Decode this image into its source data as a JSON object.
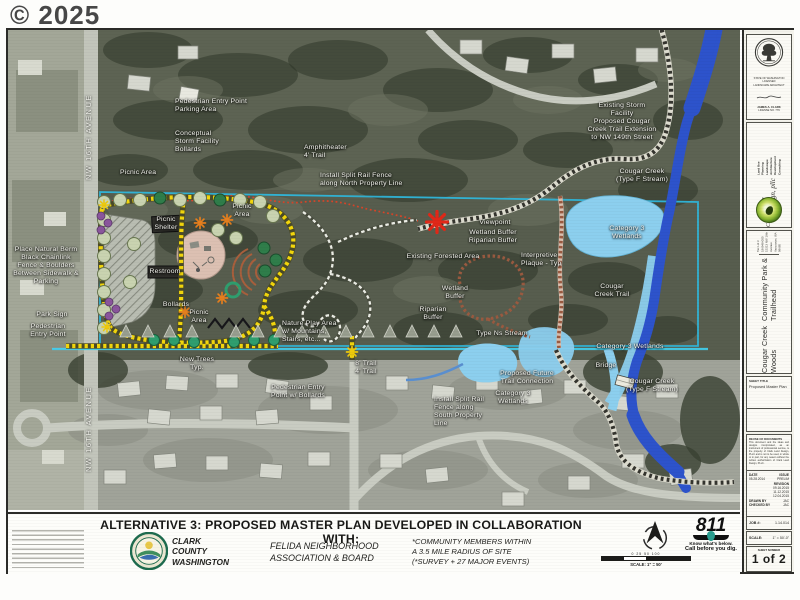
{
  "watermark": "© 2025",
  "map": {
    "street_labels": [
      {
        "name": "street-label-nw-16th-avenue-north",
        "text": "NW 16TH AVENUE"
      },
      {
        "name": "street-label-nw-16th-avenue-south",
        "text": "NW 16TH AVENUE"
      }
    ],
    "labels": [
      {
        "name": "label-pedestrian-entry-parking",
        "text": "Pedestrian Entry Point\nParking Area",
        "x": 167,
        "y": 76,
        "align": "left"
      },
      {
        "name": "label-conceptual-storm-facility",
        "text": "Conceptual\nStorm Facility\nBollards",
        "x": 167,
        "y": 112,
        "align": "left"
      },
      {
        "name": "label-picnic-area-west",
        "text": "Picnic Area",
        "x": 112,
        "y": 143,
        "align": "left"
      },
      {
        "name": "label-amphitheater",
        "text": "Amphitheater\n4' Trail",
        "x": 296,
        "y": 122,
        "align": "left"
      },
      {
        "name": "label-fence-north",
        "text": "Install Split Rail Fence\nalong North Property Line",
        "x": 312,
        "y": 150,
        "align": "left"
      },
      {
        "name": "label-existing-storm-facility",
        "text": "Existing Storm\nFacility\nProposed Cougar\nCreek Trail Extension\nto NW 149th Street",
        "x": 614,
        "y": 92,
        "align": "center"
      },
      {
        "name": "label-cougar-creek-north",
        "text": "Cougar Creek\n(Type F Stream)",
        "x": 634,
        "y": 146,
        "align": "center"
      },
      {
        "name": "label-viewpoint",
        "text": "Viewpoint",
        "x": 487,
        "y": 193,
        "align": "center"
      },
      {
        "name": "label-wetland-riparian-buffer",
        "text": "Wetland Buffer\nRiparian Buffer",
        "x": 485,
        "y": 207,
        "align": "center"
      },
      {
        "name": "label-existing-forested-area",
        "text": "Existing Forested Area",
        "x": 435,
        "y": 227,
        "align": "center"
      },
      {
        "name": "label-interpretive-plaque",
        "text": "Interpretive\nPlaque - Typ",
        "x": 513,
        "y": 230,
        "align": "left"
      },
      {
        "name": "label-wetland-buffer",
        "text": "Wetland\nBuffer",
        "x": 447,
        "y": 263,
        "align": "center"
      },
      {
        "name": "label-riparian-buffer",
        "text": "Riparian\nBuffer",
        "x": 425,
        "y": 284,
        "align": "center"
      },
      {
        "name": "label-type-ns-stream",
        "text": "Type Ns Stream",
        "x": 494,
        "y": 304,
        "align": "center"
      },
      {
        "name": "label-category3-wetlands",
        "text": "Category 3\nWetlands",
        "x": 619,
        "y": 203,
        "align": "center"
      },
      {
        "name": "label-cougar-creek-trail",
        "text": "Cougar\nCreek Trail",
        "x": 604,
        "y": 261,
        "align": "center"
      },
      {
        "name": "label-category3-wetlands-south",
        "text": "Category 3 Wetlands",
        "x": 622,
        "y": 317,
        "align": "center"
      },
      {
        "name": "label-bridge",
        "text": "Bridge",
        "x": 598,
        "y": 336,
        "align": "center"
      },
      {
        "name": "label-cougar-creek-south",
        "text": "Cougar Creek\n(Type F Stream)",
        "x": 644,
        "y": 356,
        "align": "center"
      },
      {
        "name": "label-future-trail-connection",
        "text": "Proposed Future\nTrail Connection",
        "x": 519,
        "y": 348,
        "align": "center"
      },
      {
        "name": "label-category3-wetlands-small",
        "text": "Category 3\nWetlands",
        "x": 505,
        "y": 368,
        "align": "center"
      },
      {
        "name": "label-fence-south",
        "text": "Install Split Rail\nFence along\nSouth Property\nLine",
        "x": 426,
        "y": 382,
        "align": "left"
      },
      {
        "name": "label-natural-berm",
        "text": "Place Natural Berm\nBlack Chainlink\nFence & Boulders\nBetween Sidewalk &\nParking",
        "x": 38,
        "y": 236,
        "align": "center"
      },
      {
        "name": "label-park-sign",
        "text": "Park Sign",
        "x": 44,
        "y": 285,
        "align": "center"
      },
      {
        "name": "label-pedestrian-entry-west",
        "text": "Pedestrian\nEntry Point",
        "x": 40,
        "y": 301,
        "align": "center"
      },
      {
        "name": "label-picnic-shelter",
        "text": "Picnic\nShelter",
        "x": 158,
        "y": 194,
        "align": "center"
      },
      {
        "name": "label-picnic-area-north",
        "text": "Picnic\nArea",
        "x": 234,
        "y": 181,
        "align": "center"
      },
      {
        "name": "label-restroom",
        "text": "Restroom",
        "x": 157,
        "y": 242,
        "align": "center"
      },
      {
        "name": "label-bollards",
        "text": "Bollards",
        "x": 168,
        "y": 275,
        "align": "center"
      },
      {
        "name": "label-picnic-area-south",
        "text": "Picnic\nArea",
        "x": 191,
        "y": 287,
        "align": "center"
      },
      {
        "name": "label-nature-play-area",
        "text": "Nature Play Area\nw/ Mountains,\nStairs, etc...",
        "x": 274,
        "y": 302,
        "align": "left"
      },
      {
        "name": "label-new-trees",
        "text": "New Trees\nTyp.",
        "x": 189,
        "y": 334,
        "align": "center"
      },
      {
        "name": "label-pedestrian-entry-bollards",
        "text": "Pedestrian Entry\nPoint w/ Bollards",
        "x": 290,
        "y": 362,
        "align": "center"
      },
      {
        "name": "label-trail-widths",
        "text": "8' Trail\n4' Trail",
        "x": 358,
        "y": 338,
        "align": "center"
      }
    ]
  },
  "banner": {
    "heading": "ALTERNATIVE 3: PROPOSED MASTER PLAN DEVELOPED IN COLLABORATION WITH:",
    "partners": {
      "clark_county": "CLARK\nCOUNTY\nWASHINGTON",
      "felida": "FELIDA NEIGHBORHOOD\nASSOCIATION & BOARD",
      "community": "*COMMUNITY MEMBERS WITHIN\nA 3.5 MILE RADIUS  OF SITE\n(*SURVEY + 27 MAJOR EVENTS)"
    },
    "scale_bar": {
      "ticks_text": "0    25    50              100",
      "label": "SCALE: 1\" = 50'"
    },
    "call811": {
      "number": "811",
      "line1": "Know what's below.",
      "line2": "Call before you dig."
    }
  },
  "titleblock": {
    "stamp": {
      "org": "STATE OF WASHINGTON\nLICENSED\nLANDSCAPE ARCHITECT",
      "name": "JAMES A. CLARK",
      "license": "LICENSE NO. 779"
    },
    "firm": {
      "name1": "Clark",
      "name2": "Land Design, pllc",
      "services": "Land Use Planning\nLandscape Architecture\nDevelopment Consulting"
    },
    "project": {
      "title1": "Cougar Creek Woods",
      "title2": "Community Park & Trailhead",
      "address": "Tax Lot # 186948-000\n15213 NW 16th Avenue\nVancouver, WA 98685"
    },
    "sheet_title": {
      "label": "SHEET TITLE",
      "value": "Proposed Master Plan"
    },
    "reuse": {
      "label": "REUSE OF DOCUMENTS",
      "body": "This document and the ideas and designs incorporated, as an instrument of professional service, is the property of Clark Land Design, PLLC and is not to be used, in whole or in part, for any reason without the written authorization of Clark Land Design, PLLC."
    },
    "revisions": {
      "date_label": "DATE",
      "date": "05.28.2014",
      "issue_label": "ISSUE",
      "issue": "PRELIM",
      "revision_label": "REVISION",
      "revision_dates": "09.16.2015\n11.12.2015\n12.04.2015",
      "drawn_label": "DRAWN BY",
      "drawn": "JAC",
      "checked_label": "CHECKED BY",
      "checked": "JAC"
    },
    "job": {
      "label": "JOB #:",
      "value": "1.14.014"
    },
    "scale": {
      "label": "SCALE:",
      "value": "1\" = 50'-0\""
    },
    "sheet_number": {
      "label": "SHEET NUMBER",
      "value": "1 of 2"
    }
  }
}
